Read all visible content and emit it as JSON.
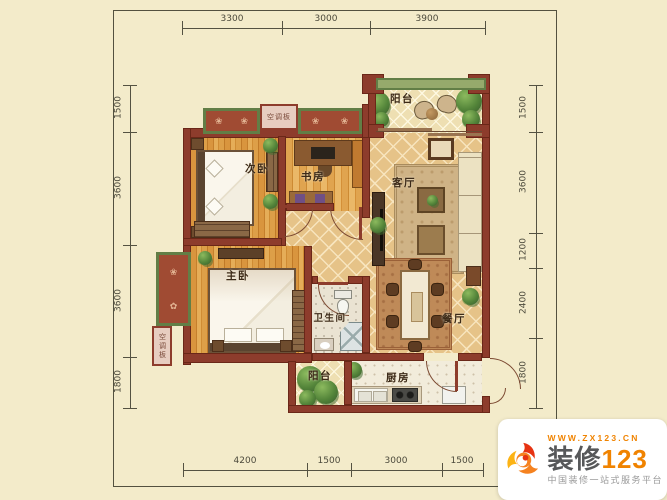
{
  "dimensions": {
    "top": [
      "3300",
      "3000",
      "3900"
    ],
    "left": [
      "1500",
      "3600",
      "3600",
      "1800"
    ],
    "right": [
      "1500",
      "3600",
      "1200",
      "2400",
      "1800"
    ],
    "bottom": [
      "4200",
      "1500",
      "3000",
      "1500"
    ]
  },
  "rooms": {
    "balcony_top": "阳台",
    "secondary_bedroom": "次卧",
    "study": "书房",
    "living_room": "客厅",
    "master_bedroom": "主卧",
    "bathroom": "卫生间",
    "dining_room": "餐厅",
    "balcony_bottom": "阳台",
    "kitchen": "厨房",
    "ac_panel_top": "空调板",
    "ac_panel_left": "空调板"
  },
  "logo": {
    "website": "WWW.ZX123.CN",
    "brand_text": "装修",
    "brand_number": "123",
    "tagline": "中国装修一站式服务平台",
    "brand_orange": "#f08300"
  },
  "colors": {
    "background": "#f3ebca",
    "wall": "#8d3c2c",
    "wood_floor": "#d3913a",
    "tile_floor": "#e6c388",
    "window_frame": "#627e46"
  }
}
